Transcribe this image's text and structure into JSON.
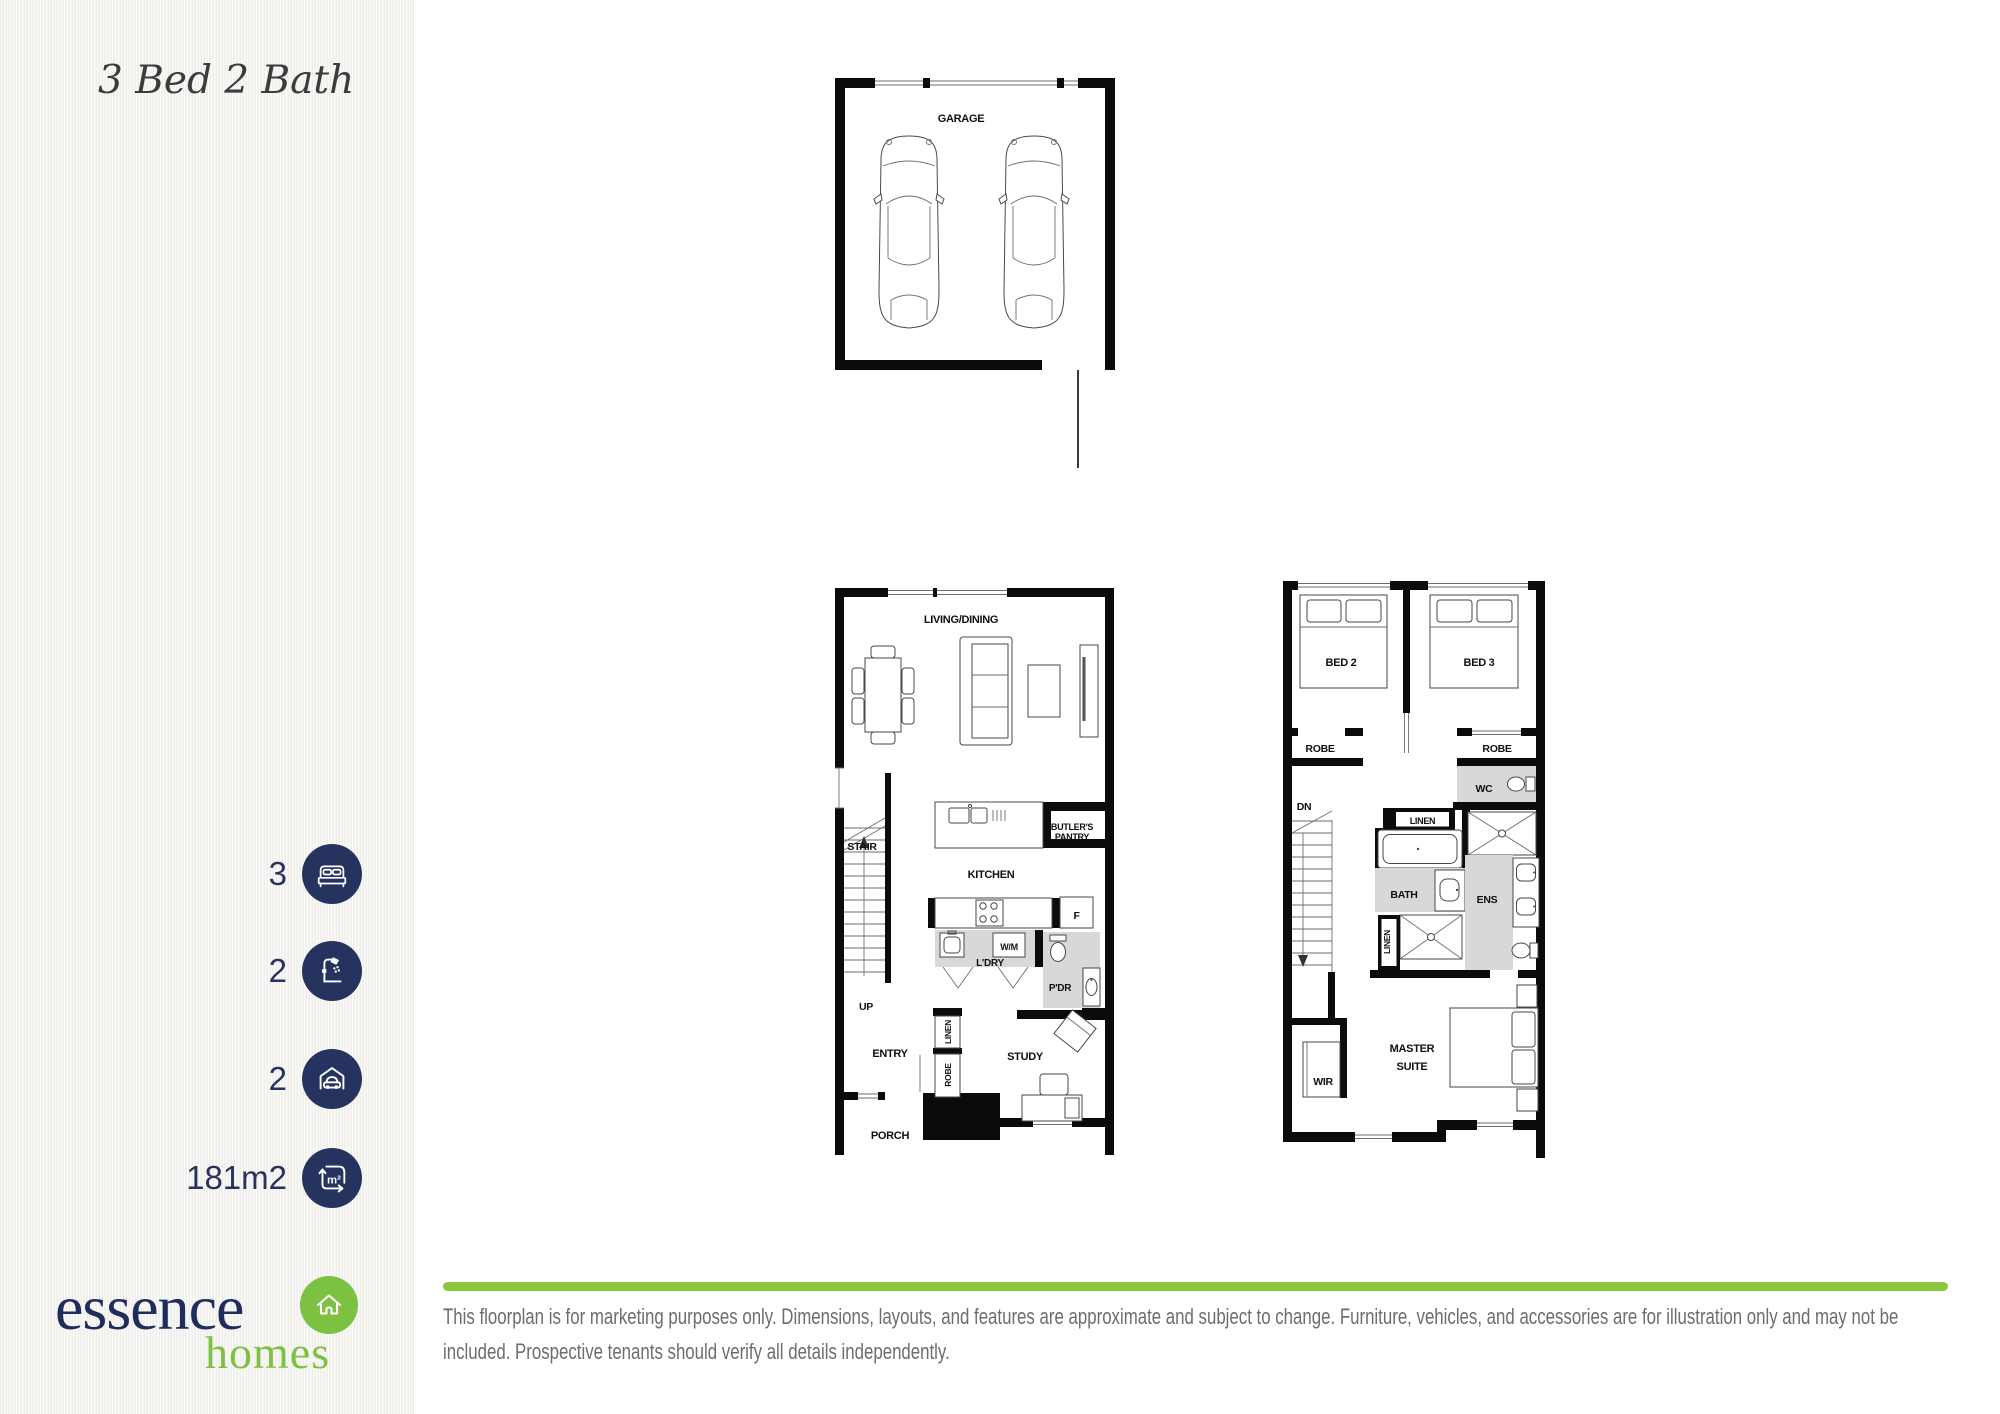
{
  "header": {
    "title": "3 Bed 2 Bath"
  },
  "specs": [
    {
      "label": "bedrooms",
      "value": "3"
    },
    {
      "label": "bathrooms",
      "value": "2"
    },
    {
      "label": "garage-spaces",
      "value": "2"
    },
    {
      "label": "area",
      "value": "181m2"
    }
  ],
  "icons": {
    "area_glyph": "m²"
  },
  "logo": {
    "brand": "essence",
    "sub": "homes"
  },
  "plans": {
    "garage": {
      "title": "GARAGE"
    },
    "ground": {
      "living_dining": "LIVING/DINING",
      "stair": "STAIR",
      "up": "UP",
      "kitchen": "KITCHEN",
      "butlers_line1": "BUTLER'S",
      "butlers_line2": "PANTRY",
      "fridge": "F",
      "wm": "W/M",
      "ldry": "L'DRY",
      "pdr": "P'DR",
      "entry": "ENTRY",
      "linen": "LINEN",
      "robe": "ROBE",
      "study": "STUDY",
      "porch": "PORCH"
    },
    "upper": {
      "bed2": "BED 2",
      "bed3": "BED 3",
      "robe_left": "ROBE",
      "robe_right": "ROBE",
      "wc": "WC",
      "dn": "DN",
      "linen_top": "LINEN",
      "bath": "BATH",
      "ens": "ENS",
      "linen_side": "LINEN",
      "wir": "WIR",
      "master_line1": "MASTER",
      "master_line2": "SUITE"
    }
  },
  "disclaimer": "This floorplan is for marketing purposes only. Dimensions, layouts, and features are approximate and subject to change. Furniture, vehicles, and accessories are for illustration only and may not be included. Prospective tenants should verify all details independently.",
  "colors": {
    "navy": "#27335f",
    "green": "#7dc142",
    "line_green": "#8dc63f",
    "gray_text": "#6d6d6d"
  }
}
